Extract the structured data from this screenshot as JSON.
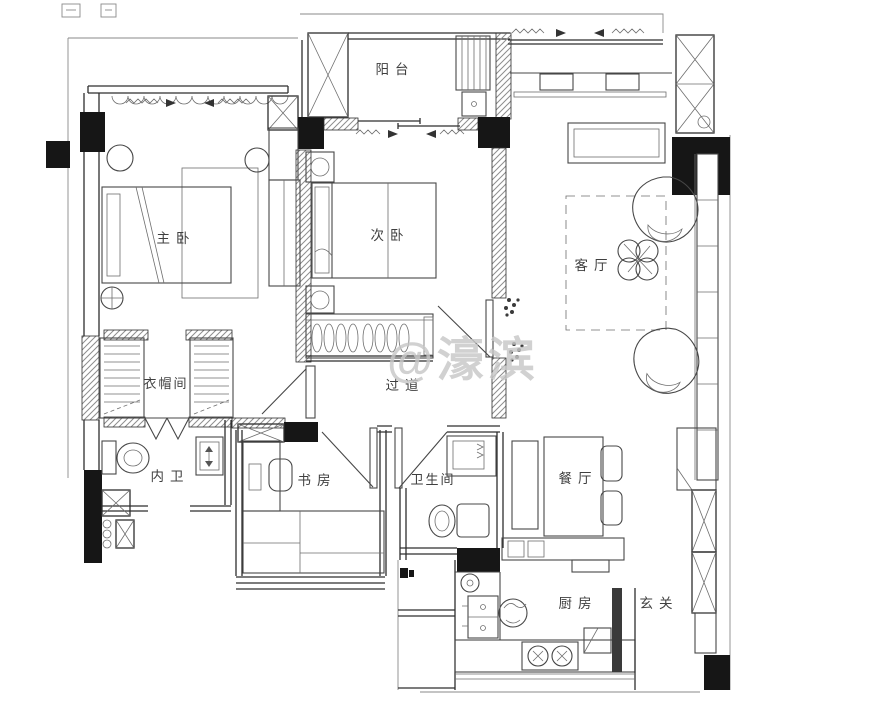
{
  "watermark": {
    "text": "@濠滨"
  },
  "rooms": [
    {
      "id": "balcony",
      "label": "阳台"
    },
    {
      "id": "master-bedroom",
      "label": "主卧"
    },
    {
      "id": "second-bedroom",
      "label": "次卧"
    },
    {
      "id": "living-room",
      "label": "客厅"
    },
    {
      "id": "cloakroom",
      "label": "衣帽间"
    },
    {
      "id": "hallway",
      "label": "过道"
    },
    {
      "id": "master-bathroom",
      "label": "内卫"
    },
    {
      "id": "study",
      "label": "书房"
    },
    {
      "id": "bathroom",
      "label": "卫生间"
    },
    {
      "id": "dining-room",
      "label": "餐厅"
    },
    {
      "id": "kitchen",
      "label": "厨房"
    },
    {
      "id": "entry",
      "label": "玄关"
    }
  ],
  "palette": {
    "wall": "#2e2e2e",
    "furniture": "#474747",
    "thin_outline": "#8a8a8a",
    "solid_column": "#161616",
    "label": "#3f3f3f",
    "watermark": "#c7c7c7",
    "background": "#ffffff"
  }
}
